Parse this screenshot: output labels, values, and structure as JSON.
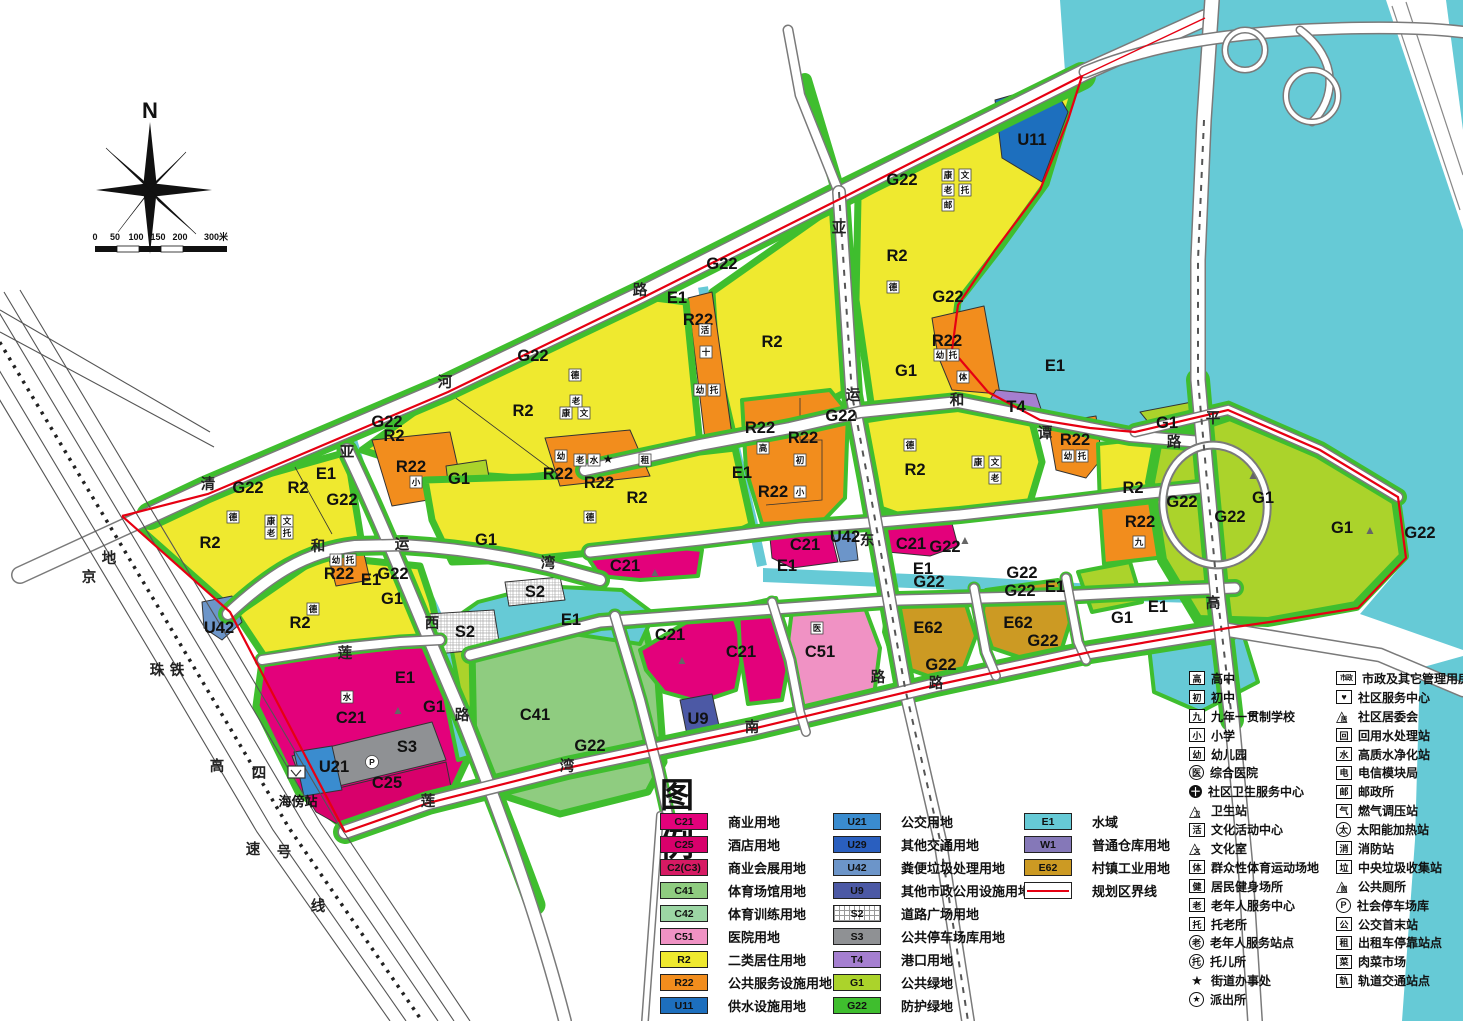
{
  "compass": {
    "label": "N"
  },
  "scale_bar": {
    "ticks": [
      "0",
      "50",
      "100",
      "150",
      "200",
      "300米"
    ]
  },
  "colors": {
    "C21": "#E3017B",
    "C25": "#D8006B",
    "C2(C3)": "#D61A63",
    "C41": "#8FCC80",
    "C42": "#9CD6A4",
    "C51": "#F092C4",
    "R2": "#EFE92F",
    "R22": "#F28D1D",
    "U11": "#1D6FBE",
    "U21": "#3A8CCF",
    "U29": "#2A5FBF",
    "U42": "#6C95C9",
    "U9": "#4C59A5",
    "S2": "#FFFFFF",
    "S3": "#8F9194",
    "T4": "#A57FD0",
    "G1": "#ABD32B",
    "G22": "#3FBE2E",
    "E1": "#66CAD6",
    "W1": "#8578B8",
    "E62": "#CC9A23",
    "boundary": "#E60012",
    "water": "#66CAD6"
  },
  "map": {
    "zone_labels": [
      {
        "code": "U11",
        "x": 1032,
        "y": 140
      },
      {
        "code": "G22",
        "x": 902,
        "y": 180
      },
      {
        "code": "R2",
        "x": 897,
        "y": 256
      },
      {
        "code": "G22",
        "x": 948,
        "y": 297
      },
      {
        "code": "G22",
        "x": 722,
        "y": 264
      },
      {
        "code": "E1",
        "x": 677,
        "y": 298
      },
      {
        "code": "R22",
        "x": 698,
        "y": 320
      },
      {
        "code": "R2",
        "x": 772,
        "y": 342
      },
      {
        "code": "G1",
        "x": 906,
        "y": 371
      },
      {
        "code": "R22",
        "x": 947,
        "y": 341
      },
      {
        "code": "T4",
        "x": 1016,
        "y": 407
      },
      {
        "code": "E1",
        "x": 1055,
        "y": 366
      },
      {
        "code": "G22",
        "x": 533,
        "y": 356
      },
      {
        "code": "R2",
        "x": 523,
        "y": 411
      },
      {
        "code": "G22",
        "x": 387,
        "y": 422
      },
      {
        "code": "R2",
        "x": 394,
        "y": 436
      },
      {
        "code": "R22",
        "x": 411,
        "y": 467
      },
      {
        "code": "G1",
        "x": 459,
        "y": 479
      },
      {
        "code": "G1",
        "x": 486,
        "y": 540
      },
      {
        "code": "E1",
        "x": 326,
        "y": 474
      },
      {
        "code": "G22",
        "x": 342,
        "y": 500
      },
      {
        "code": "R2",
        "x": 298,
        "y": 488
      },
      {
        "code": "G22",
        "x": 248,
        "y": 488
      },
      {
        "code": "R2",
        "x": 210,
        "y": 543
      },
      {
        "code": "R22",
        "x": 339,
        "y": 574
      },
      {
        "code": "E1",
        "x": 371,
        "y": 580
      },
      {
        "code": "G22",
        "x": 393,
        "y": 574
      },
      {
        "code": "G1",
        "x": 392,
        "y": 599
      },
      {
        "code": "U42",
        "x": 219,
        "y": 628
      },
      {
        "code": "R2",
        "x": 300,
        "y": 623
      },
      {
        "code": "R22",
        "x": 558,
        "y": 474
      },
      {
        "code": "R22",
        "x": 599,
        "y": 483
      },
      {
        "code": "R2",
        "x": 637,
        "y": 498
      },
      {
        "code": "R22",
        "x": 760,
        "y": 428
      },
      {
        "code": "R22",
        "x": 803,
        "y": 438
      },
      {
        "code": "R22",
        "x": 773,
        "y": 492
      },
      {
        "code": "E1",
        "x": 742,
        "y": 473
      },
      {
        "code": "G22",
        "x": 841,
        "y": 416
      },
      {
        "code": "R2",
        "x": 915,
        "y": 470
      },
      {
        "code": "C21",
        "x": 805,
        "y": 545
      },
      {
        "code": "U42",
        "x": 845,
        "y": 537
      },
      {
        "code": "C21",
        "x": 911,
        "y": 544
      },
      {
        "code": "G22",
        "x": 945,
        "y": 547
      },
      {
        "code": "E1",
        "x": 787,
        "y": 566
      },
      {
        "code": "E1",
        "x": 923,
        "y": 569
      },
      {
        "code": "G22",
        "x": 929,
        "y": 582
      },
      {
        "code": "G22",
        "x": 1022,
        "y": 573
      },
      {
        "code": "G22",
        "x": 1020,
        "y": 591
      },
      {
        "code": "E1",
        "x": 1055,
        "y": 587
      },
      {
        "code": "C21",
        "x": 625,
        "y": 566
      },
      {
        "code": "S2",
        "x": 535,
        "y": 592
      },
      {
        "code": "S2",
        "x": 465,
        "y": 632
      },
      {
        "code": "E1",
        "x": 571,
        "y": 620
      },
      {
        "code": "C21",
        "x": 670,
        "y": 635
      },
      {
        "code": "C21",
        "x": 741,
        "y": 652
      },
      {
        "code": "C51",
        "x": 820,
        "y": 652
      },
      {
        "code": "E62",
        "x": 928,
        "y": 628
      },
      {
        "code": "G22",
        "x": 941,
        "y": 665
      },
      {
        "code": "E62",
        "x": 1018,
        "y": 623
      },
      {
        "code": "G22",
        "x": 1043,
        "y": 641
      },
      {
        "code": "C41",
        "x": 535,
        "y": 715
      },
      {
        "code": "U9",
        "x": 698,
        "y": 719
      },
      {
        "code": "G22",
        "x": 590,
        "y": 746
      },
      {
        "code": "C21",
        "x": 351,
        "y": 718
      },
      {
        "code": "S3",
        "x": 407,
        "y": 747
      },
      {
        "code": "U21",
        "x": 334,
        "y": 767
      },
      {
        "code": "C25",
        "x": 387,
        "y": 783
      },
      {
        "code": "E1",
        "x": 405,
        "y": 678
      },
      {
        "code": "G1",
        "x": 434,
        "y": 707
      },
      {
        "code": "R22",
        "x": 1075,
        "y": 440
      },
      {
        "code": "G1",
        "x": 1167,
        "y": 423
      },
      {
        "code": "R2",
        "x": 1133,
        "y": 488
      },
      {
        "code": "G22",
        "x": 1182,
        "y": 502
      },
      {
        "code": "R22",
        "x": 1140,
        "y": 522
      },
      {
        "code": "G1",
        "x": 1263,
        "y": 498
      },
      {
        "code": "G1",
        "x": 1342,
        "y": 528
      },
      {
        "code": "G22",
        "x": 1420,
        "y": 533
      },
      {
        "code": "G22",
        "x": 1230,
        "y": 517
      },
      {
        "code": "G1",
        "x": 1122,
        "y": 618
      },
      {
        "code": "E1",
        "x": 1158,
        "y": 607
      }
    ],
    "road_chars": [
      {
        "ch": "清",
        "x": 208,
        "y": 484
      },
      {
        "ch": "河",
        "x": 445,
        "y": 382
      },
      {
        "ch": "路",
        "x": 640,
        "y": 290
      },
      {
        "ch": "亚",
        "x": 839,
        "y": 228
      },
      {
        "ch": "亚",
        "x": 347,
        "y": 452
      },
      {
        "ch": "和",
        "x": 318,
        "y": 546
      },
      {
        "ch": "运",
        "x": 402,
        "y": 544
      },
      {
        "ch": "湾",
        "x": 548,
        "y": 563
      },
      {
        "ch": "西",
        "x": 432,
        "y": 623
      },
      {
        "ch": "路",
        "x": 462,
        "y": 715
      },
      {
        "ch": "莲",
        "x": 345,
        "y": 653
      },
      {
        "ch": "运",
        "x": 853,
        "y": 395
      },
      {
        "ch": "和",
        "x": 957,
        "y": 400
      },
      {
        "ch": "谭",
        "x": 1045,
        "y": 433
      },
      {
        "ch": "路",
        "x": 1174,
        "y": 442
      },
      {
        "ch": "东",
        "x": 867,
        "y": 540
      },
      {
        "ch": "路",
        "x": 878,
        "y": 677
      },
      {
        "ch": "莲",
        "x": 428,
        "y": 801
      },
      {
        "ch": "湾",
        "x": 567,
        "y": 766
      },
      {
        "ch": "南",
        "x": 752,
        "y": 727
      },
      {
        "ch": "路",
        "x": 936,
        "y": 683
      },
      {
        "ch": "平",
        "x": 1213,
        "y": 418
      },
      {
        "ch": "高",
        "x": 1213,
        "y": 603
      },
      {
        "ch": "京",
        "x": 89,
        "y": 577
      },
      {
        "ch": "珠",
        "x": 157,
        "y": 670
      },
      {
        "ch": "高",
        "x": 217,
        "y": 766
      },
      {
        "ch": "速",
        "x": 253,
        "y": 849
      },
      {
        "ch": "地",
        "x": 109,
        "y": 558
      },
      {
        "ch": "铁",
        "x": 177,
        "y": 670
      },
      {
        "ch": "四",
        "x": 259,
        "y": 773
      },
      {
        "ch": "号",
        "x": 284,
        "y": 852
      },
      {
        "ch": "线",
        "x": 318,
        "y": 906
      }
    ],
    "facility_icons": [
      {
        "ch": "德",
        "x": 893,
        "y": 287
      },
      {
        "ch": "康",
        "x": 948,
        "y": 175
      },
      {
        "ch": "文",
        "x": 965,
        "y": 175
      },
      {
        "ch": "老",
        "x": 948,
        "y": 190
      },
      {
        "ch": "托",
        "x": 965,
        "y": 190
      },
      {
        "ch": "邮",
        "x": 948,
        "y": 205
      },
      {
        "ch": "幼",
        "x": 940,
        "y": 355
      },
      {
        "ch": "托",
        "x": 953,
        "y": 355
      },
      {
        "ch": "体",
        "x": 963,
        "y": 377
      },
      {
        "ch": "活",
        "x": 705,
        "y": 330
      },
      {
        "ch": "十",
        "x": 706,
        "y": 352
      },
      {
        "ch": "幼",
        "x": 700,
        "y": 390
      },
      {
        "ch": "托",
        "x": 714,
        "y": 390
      },
      {
        "ch": "德",
        "x": 575,
        "y": 375
      },
      {
        "ch": "老",
        "x": 576,
        "y": 401
      },
      {
        "ch": "康",
        "x": 566,
        "y": 413
      },
      {
        "ch": "文",
        "x": 584,
        "y": 413
      },
      {
        "ch": "幼",
        "x": 561,
        "y": 456
      },
      {
        "ch": "老",
        "x": 580,
        "y": 460
      },
      {
        "ch": "水",
        "x": 594,
        "y": 460
      },
      {
        "ch": "★",
        "x": 608,
        "y": 459
      },
      {
        "ch": "租",
        "x": 645,
        "y": 460
      },
      {
        "ch": "小",
        "x": 416,
        "y": 482
      },
      {
        "ch": "德",
        "x": 233,
        "y": 517
      },
      {
        "ch": "康",
        "x": 271,
        "y": 521
      },
      {
        "ch": "文",
        "x": 287,
        "y": 521
      },
      {
        "ch": "老",
        "x": 271,
        "y": 533
      },
      {
        "ch": "托",
        "x": 287,
        "y": 533
      },
      {
        "ch": "幼",
        "x": 336,
        "y": 560
      },
      {
        "ch": "托",
        "x": 350,
        "y": 560
      },
      {
        "ch": "德",
        "x": 313,
        "y": 609
      },
      {
        "ch": "德",
        "x": 590,
        "y": 517
      },
      {
        "ch": "高",
        "x": 763,
        "y": 448
      },
      {
        "ch": "初",
        "x": 800,
        "y": 460
      },
      {
        "ch": "小",
        "x": 800,
        "y": 492
      },
      {
        "ch": "德",
        "x": 910,
        "y": 445
      },
      {
        "ch": "康",
        "x": 978,
        "y": 462
      },
      {
        "ch": "文",
        "x": 995,
        "y": 462
      },
      {
        "ch": "老",
        "x": 995,
        "y": 478
      },
      {
        "ch": "幼",
        "x": 1068,
        "y": 456
      },
      {
        "ch": "托",
        "x": 1082,
        "y": 456
      },
      {
        "ch": "九",
        "x": 1139,
        "y": 542
      },
      {
        "ch": "医",
        "x": 817,
        "y": 628
      },
      {
        "ch": "水",
        "x": 347,
        "y": 697
      },
      {
        "ch": "▲",
        "x": 398,
        "y": 710
      },
      {
        "ch": "▲",
        "x": 655,
        "y": 572
      },
      {
        "ch": "▲",
        "x": 682,
        "y": 660
      },
      {
        "ch": "▲",
        "x": 965,
        "y": 540
      },
      {
        "ch": "▲",
        "x": 1253,
        "y": 475
      },
      {
        "ch": "▲",
        "x": 1370,
        "y": 530
      },
      {
        "ch": "P",
        "x": 372,
        "y": 762
      }
    ],
    "station": {
      "label": "海傍站",
      "x": 298,
      "y": 806
    }
  },
  "legend": {
    "title": "图 例",
    "col1": [
      {
        "code": "C21",
        "label": "商业用地"
      },
      {
        "code": "C25",
        "label": "酒店用地"
      },
      {
        "code": "C2(C3)",
        "label": "商业会展用地"
      },
      {
        "code": "C41",
        "label": "体育场馆用地"
      },
      {
        "code": "C42",
        "label": "体育训练用地"
      },
      {
        "code": "C51",
        "label": "医院用地"
      },
      {
        "code": "R2",
        "label": "二类居住用地"
      },
      {
        "code": "R22",
        "label": "公共服务设施用地"
      },
      {
        "code": "U11",
        "label": "供水设施用地"
      }
    ],
    "col2": [
      {
        "code": "U21",
        "label": "公交用地"
      },
      {
        "code": "U29",
        "label": "其他交通用地"
      },
      {
        "code": "U42",
        "label": "粪便垃圾处理用地"
      },
      {
        "code": "U9",
        "label": "其他市政公用设施用地"
      },
      {
        "code": "S2",
        "label": "道路广场用地"
      },
      {
        "code": "S3",
        "label": "公共停车场库用地"
      },
      {
        "code": "T4",
        "label": "港口用地"
      },
      {
        "code": "G1",
        "label": "公共绿地"
      },
      {
        "code": "G22",
        "label": "防护绿地"
      }
    ],
    "col3": [
      {
        "code": "E1",
        "label": "水域"
      },
      {
        "code": "W1",
        "label": "普通仓库用地"
      },
      {
        "code": "E62",
        "label": "村镇工业用地"
      },
      {
        "code": "__boundary",
        "label": "规划区界线"
      }
    ]
  },
  "icon_legend": {
    "colA": [
      {
        "g": "高",
        "s": "box",
        "label": "高中"
      },
      {
        "g": "初",
        "s": "box",
        "label": "初中"
      },
      {
        "g": "九",
        "s": "box",
        "label": "九年一贯制学校"
      },
      {
        "g": "小",
        "s": "box",
        "label": "小学"
      },
      {
        "g": "幼",
        "s": "box",
        "label": "幼儿园"
      },
      {
        "g": "医",
        "s": "circle",
        "label": "综合医院"
      },
      {
        "g": "十",
        "s": "disc",
        "label": "社区卫生服务中心"
      },
      {
        "g": "卫",
        "s": "tri",
        "label": "卫生站"
      },
      {
        "g": "活",
        "s": "box",
        "label": "文化活动中心"
      },
      {
        "g": "文",
        "s": "tri",
        "label": "文化室"
      },
      {
        "g": "体",
        "s": "box",
        "label": "群众性体育运动场地"
      },
      {
        "g": "健",
        "s": "box",
        "label": "居民健身场所"
      },
      {
        "g": "老",
        "s": "box",
        "label": "老年人服务中心"
      },
      {
        "g": "托",
        "s": "box",
        "label": "托老所"
      },
      {
        "g": "老",
        "s": "circle",
        "label": "老年人服务站点"
      },
      {
        "g": "托",
        "s": "circle",
        "label": "托儿所"
      },
      {
        "g": "★",
        "s": "plain",
        "label": "街道办事处"
      },
      {
        "g": "★",
        "s": "circle",
        "label": "派出所"
      }
    ],
    "colB": [
      {
        "g": "市政",
        "s": "box2",
        "label": "市政及其它管理用房"
      },
      {
        "g": "♥",
        "s": "box",
        "label": "社区服务中心"
      },
      {
        "g": "居",
        "s": "tri",
        "label": "社区居委会"
      },
      {
        "g": "回",
        "s": "box",
        "label": "回用水处理站"
      },
      {
        "g": "水",
        "s": "box",
        "label": "高质水净化站"
      },
      {
        "g": "电",
        "s": "box",
        "label": "电信模块局"
      },
      {
        "g": "邮",
        "s": "box",
        "label": "邮政所"
      },
      {
        "g": "气",
        "s": "box",
        "label": "燃气调压站"
      },
      {
        "g": "太",
        "s": "circle",
        "label": "太阳能加热站"
      },
      {
        "g": "消",
        "s": "box",
        "label": "消防站"
      },
      {
        "g": "垃",
        "s": "box",
        "label": "中央垃圾收集站"
      },
      {
        "g": "厕",
        "s": "tri",
        "label": "公共厕所"
      },
      {
        "g": "P",
        "s": "circle",
        "label": "社会停车场库"
      },
      {
        "g": "公",
        "s": "box",
        "label": "公交首末站"
      },
      {
        "g": "租",
        "s": "box",
        "label": "出租车停靠站点"
      },
      {
        "g": "菜",
        "s": "box",
        "label": "肉菜市场"
      },
      {
        "g": "轨",
        "s": "box",
        "label": "轨道交通站点"
      }
    ]
  }
}
